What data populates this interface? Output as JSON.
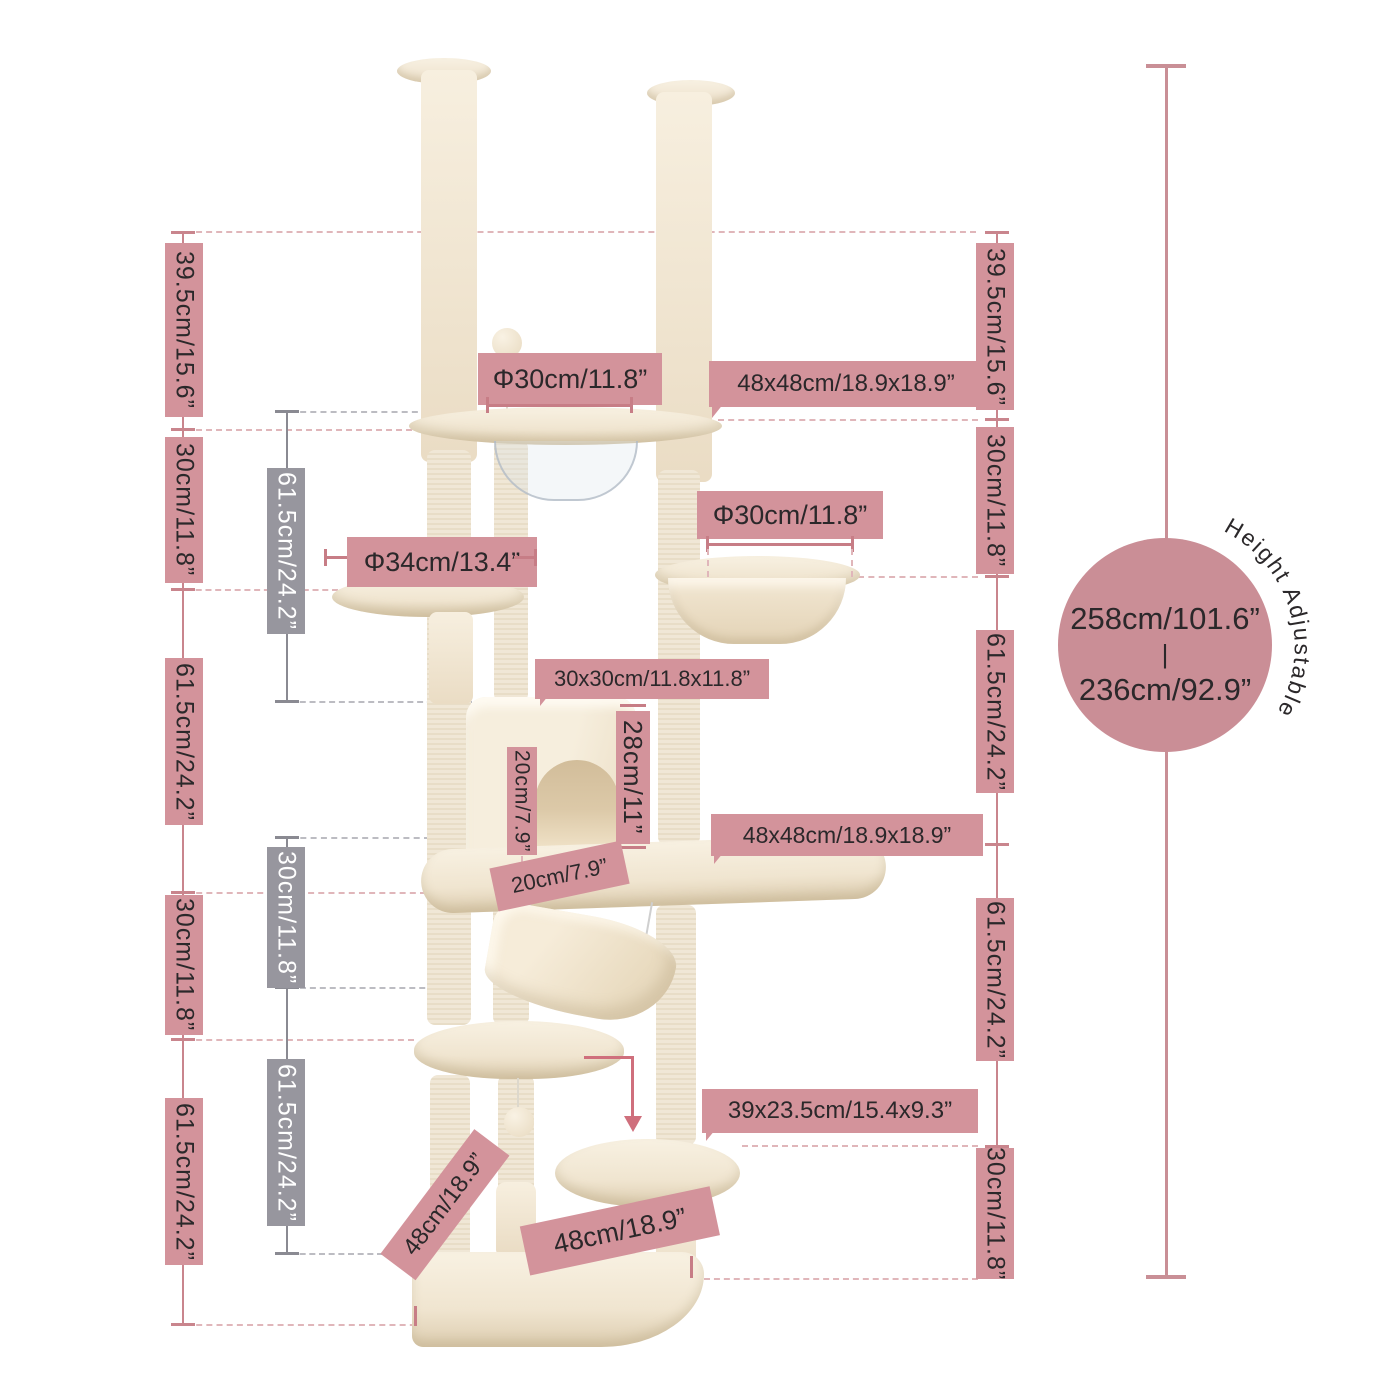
{
  "colors": {
    "pink_label": "#d3939b",
    "pink_line": "#c9858d",
    "pink_dash": "#e0b6ba",
    "gray_label": "#97969e",
    "gray_line": "#8a8a92",
    "gray_dash": "#bcbcc2",
    "badge_circle": "#ca8e96",
    "text_dark": "#2b282a",
    "text_light": "#ffffff",
    "plush": "#f3e9d8",
    "sisal": "#ece2cf"
  },
  "left_outer": [
    "39.5cm/15.6”",
    "30cm/11.8”",
    "61.5cm/24.2”",
    "30cm/11.8”",
    "61.5cm/24.2”"
  ],
  "left_inner": [
    "61.5cm/24.2”",
    "30cm/11.8”",
    "61.5cm/24.2”"
  ],
  "right_outer": [
    "39.5cm/15.6”",
    "30cm/11.8”",
    "61.5cm/24.2”",
    "61.5cm/24.2”",
    "30cm/11.8”"
  ],
  "annotations": {
    "top_perch_diameter": "Φ30cm/11.8”",
    "top_platform_size": "48x48cm/18.9x18.9”",
    "round_platform_diameter": "Φ34cm/13.4”",
    "basket_diameter": "Φ30cm/11.8”",
    "condo_size": "30x30cm/11.8x11.8”",
    "condo_height": "28cm/11”",
    "condo_door_height": "20cm/7.9”",
    "condo_door_width": "20cm/7.9”",
    "middle_platform_size": "48x48cm/18.9x18.9”",
    "step_platform_size": "39x23.5cm/15.4x9.3”",
    "base_side": "48cm/18.9”",
    "base_front": "48cm/18.9”"
  },
  "height_badge": {
    "max": "258cm/101.6”",
    "divider": "|",
    "min": "236cm/92.9”",
    "label": "Height Adjustable"
  }
}
